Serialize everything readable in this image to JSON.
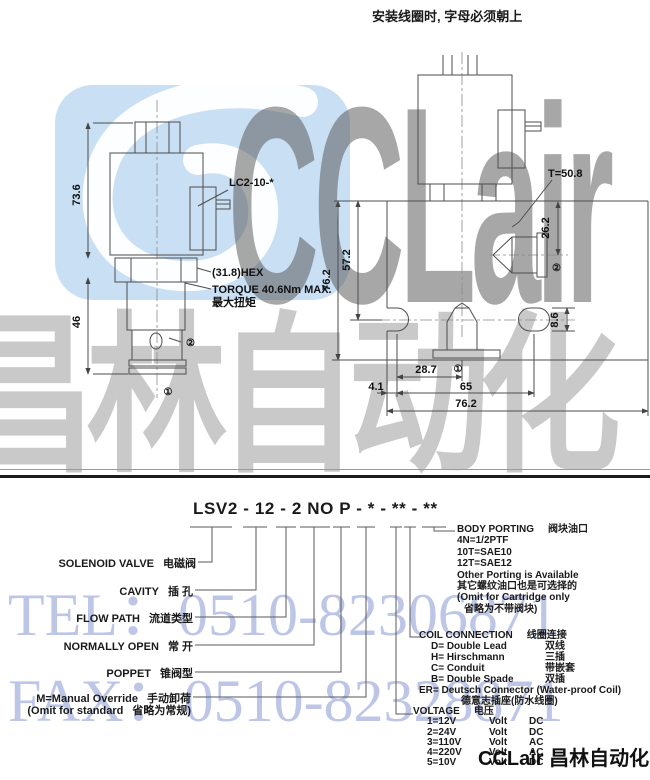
{
  "note": {
    "install": "安装线圈时, 字母必须朝上"
  },
  "watermarks": {
    "brand": "CCLair",
    "brand_cn": "昌林自动化",
    "tel": "TEL：0510-82306871",
    "fax": "FAX：0510-82328871",
    "footer": "CCLair 昌林自动化"
  },
  "colors": {
    "watermark_blue": "#c6ddf3",
    "watermark_blue_text": "#97a8d8",
    "drawing_line": "#4d4d4d"
  },
  "left_view": {
    "coil_model": "LC2-10-*",
    "hex": "(31.8)HEX",
    "torque": "TORQUE 40.6Nm MAX.",
    "torque_cn": "最大扭矩",
    "dim_coil_height": "73.6",
    "dim_cartridge": "46",
    "port1": "①",
    "port2": "②"
  },
  "right_view": {
    "install_torque": "T=50.8",
    "dim_port2": "26.2",
    "dim_center": "57.2",
    "dim_body_v": "76.2",
    "dim_slot": "8.6",
    "dim_port1_x": "28.7",
    "dim_edge": "4.1",
    "dim_slot_span": "65",
    "dim_body_h": "76.2",
    "port1": "①",
    "port2": "②"
  },
  "ordering": {
    "model_code": "LSV2 - 12 - 2 NO P - * - ** - **",
    "left_labels": [
      {
        "en": "SOLENOID VALVE",
        "cn": "电磁阀"
      },
      {
        "en": "CAVITY",
        "cn": "插 孔"
      },
      {
        "en": "FLOW PATH",
        "cn": "流道类型"
      },
      {
        "en": "NORMALLY OPEN",
        "cn": "常 开"
      },
      {
        "en": "POPPET",
        "cn": "锥阀型"
      },
      {
        "en": "M=Manual Override",
        "cn": "手动卸荷"
      },
      {
        "en": "(Omit for standard",
        "cn": "省略为常规)"
      }
    ],
    "body_porting": {
      "title_en": "BODY PORTING",
      "title_cn": "阀块油口",
      "lines": [
        "4N=1/2PTF",
        "10T=SAE10",
        "12T=SAE12",
        "Other Porting is Available",
        "其它螺纹油口也是可选择的",
        "(Omit for Cartridge only",
        "省略为不带阀块)"
      ]
    },
    "coil_connection": {
      "title_en": "COIL CONNECTION",
      "title_cn": "线圈连接",
      "items": [
        {
          "opt": "D= Double Lead",
          "cn": "双线"
        },
        {
          "opt": "H= Hirschmann",
          "cn": "三插"
        },
        {
          "opt": "C= Conduit",
          "cn": "带嵌套"
        },
        {
          "opt": "B= Double Spade",
          "cn": "双插"
        }
      ],
      "er": "ER= Deutsch Connector (Water-proof Coil)",
      "er_cn": "德意志插座(防水线圈)"
    },
    "voltage": {
      "title_en": "VOLTAGE",
      "title_cn": "电压",
      "items": [
        {
          "code": "1=12V",
          "unit": "Volt",
          "type": "DC"
        },
        {
          "code": "2=24V",
          "unit": "Volt",
          "type": "DC"
        },
        {
          "code": "3=110V",
          "unit": "Volt",
          "type": "AC"
        },
        {
          "code": "4=220V",
          "unit": "Volt",
          "type": "AC"
        },
        {
          "code": "5=10V",
          "unit": "Volt",
          "type": "DC"
        }
      ]
    }
  }
}
